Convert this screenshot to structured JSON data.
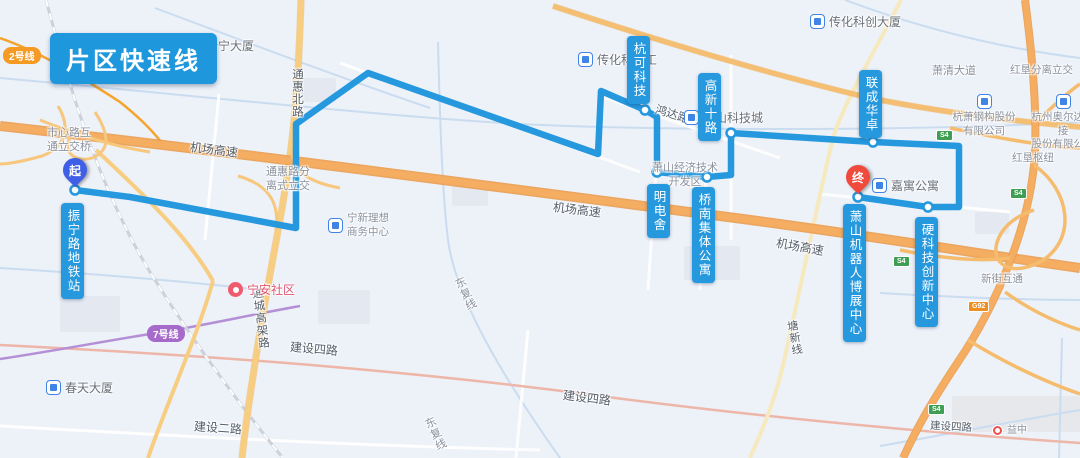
{
  "app": {
    "title_badge": "片区快速线"
  },
  "route": {
    "start_label": "起",
    "end_label": "终",
    "color": "#2598de",
    "stations": [
      {
        "name": "振宁路地铁站"
      },
      {
        "name": "杭可科技"
      },
      {
        "name": "明电舍"
      },
      {
        "name": "桥南集体公寓"
      },
      {
        "name": "高新十路"
      },
      {
        "name": "联成华卓"
      },
      {
        "name": "硬科技创新中心"
      },
      {
        "name": "萧山机器人博展中心"
      }
    ]
  },
  "metro_badges": {
    "line2": "2号线",
    "line7": "7号线"
  },
  "road_labels": {
    "airport_expressway": "机场高速",
    "tonghui_north_rd": "通惠北路",
    "tonghui_interchange": "通惠路分离式立交",
    "shixin_interchange": "市心路互通立交桥",
    "hongda_rd": "鸿达路",
    "xiaoshan_dev_zone": "萧山经济技术开发区",
    "tongcheng_viaduct": "通城高架路",
    "jianshe_4th_rd": "建设四路",
    "jianshe_2nd_rd": "建设二路",
    "tangxin_line": "塘新线",
    "xiaoqing_ave": "萧清大道",
    "hongken_interchange": "红垦分离立交",
    "hongken_hub": "红垦枢纽",
    "xinjie_interchange": "新街互通",
    "dongfu_line": "东复线"
  },
  "shields": {
    "s4": "S4",
    "g92": "G92"
  },
  "pois": {
    "xinning": "新宁大厦",
    "chuanhua_tech": "传化科技工",
    "chuanhua_tower": "传化科创大厦",
    "xiaoshan_tech_city": "萧山科技城",
    "jiayu": "嘉寓公寓",
    "hangxiao_line1": "杭萧钢构股份",
    "hangxiao_line2": "有限公司",
    "aoerda_line1": "杭州奥尔达焊接",
    "aoerda_line2": "股份有限公司",
    "ningxin_line1": "宁新理想",
    "ningxin_line2": "商务中心",
    "ningan": "宁安社区",
    "chuntian": "春天大厦",
    "yizhong": "益中"
  }
}
